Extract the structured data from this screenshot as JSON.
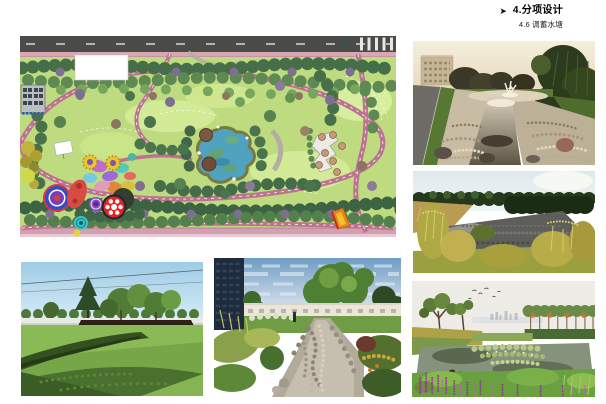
{
  "page": {
    "background": "#ffffff"
  },
  "header": {
    "bullet": "➤",
    "title": "4.分项设计",
    "subtitle": "4.6 调蓄水塘"
  },
  "palette": {
    "plan_road": "#4b4b49",
    "plan_sidewalk": "#d9a9b3",
    "plan_lawn": "#bedc7f",
    "plan_path_pink": "#bc7390",
    "plan_pond_blue": "#4fa3bf",
    "dusk_sky": "#f2ecd9",
    "day_sky": "#9ecbe6",
    "wetland_flower_purple": "#8a3f8e"
  }
}
